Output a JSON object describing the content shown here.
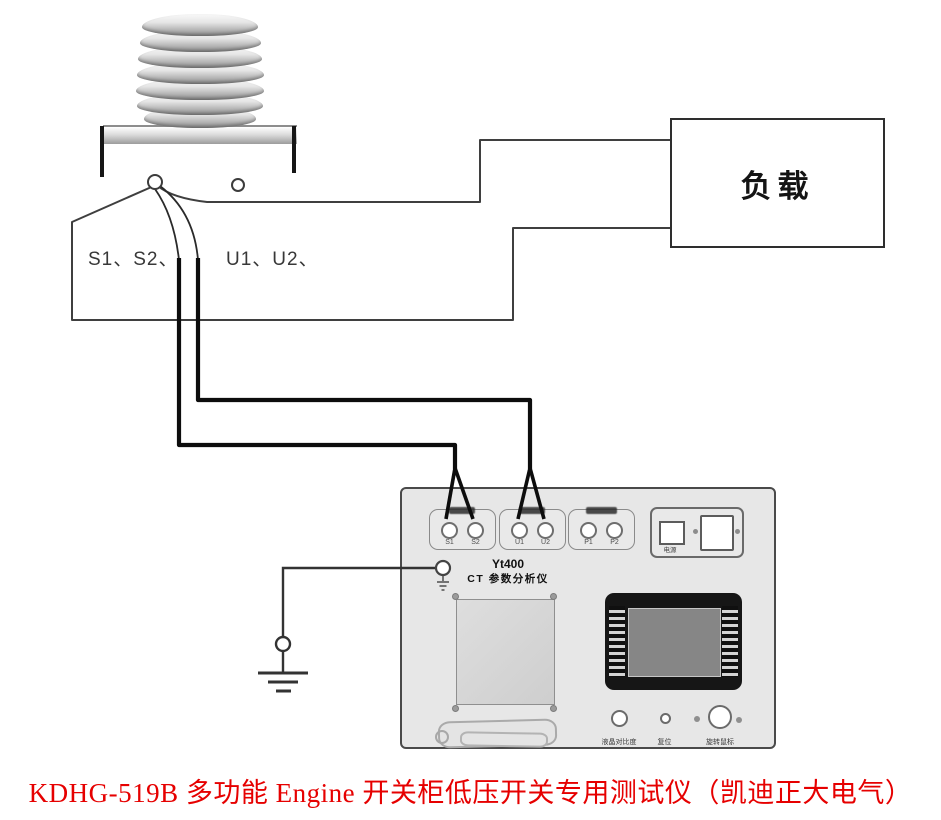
{
  "figure": {
    "caption": "KDHG-519B 多功能 Engine 开关柜低压开关专用测试仪（凯迪正大电气）",
    "caption_color": "#e60000"
  },
  "ct": {
    "secondary_label": "S1、S2、",
    "primary_label": "U1、U2、"
  },
  "load": {
    "label": "负载"
  },
  "panel": {
    "model": "Yt400",
    "name": "CT 参数分析仪",
    "groups": [
      {
        "id": "s",
        "terminals": [
          "S1",
          "S2"
        ]
      },
      {
        "id": "u",
        "terminals": [
          "U1",
          "U2"
        ]
      },
      {
        "id": "p",
        "terminals": [
          "P1",
          "P2"
        ]
      }
    ],
    "power_label": "电源",
    "controls": [
      "液晶对比度",
      "复位",
      "旋转鼠标"
    ],
    "colors": {
      "panel_fill": "#e7e7e7",
      "thin_wire": "#3f3f3f",
      "test_cable": "#0d0d0d",
      "display_bezel": "#161616",
      "screen": "#868686"
    }
  }
}
